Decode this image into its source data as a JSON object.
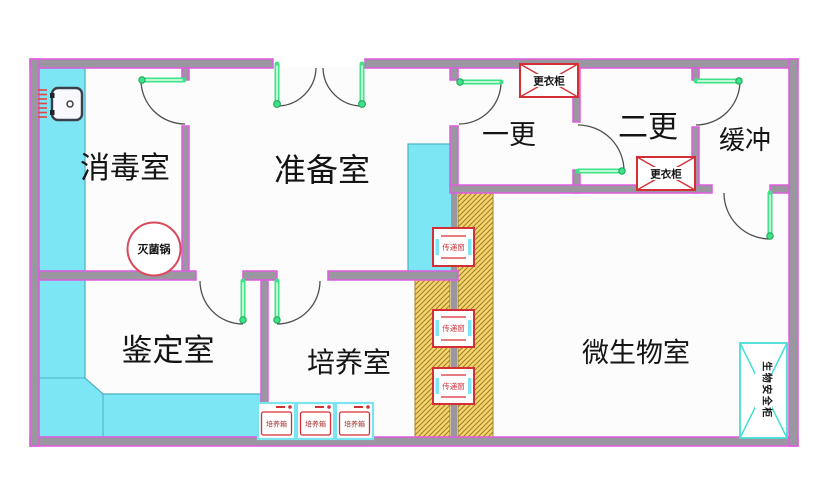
{
  "rooms": [
    {
      "label": "消毒室"
    },
    {
      "label": "准备室"
    },
    {
      "label": "一更"
    },
    {
      "label": "二更"
    },
    {
      "label": "缓冲"
    },
    {
      "label": "鉴定室"
    },
    {
      "label": "培养室"
    },
    {
      "label": "微生物室"
    }
  ],
  "equipment": {
    "sterilizer_label": "灭菌锅",
    "locker_label": "更衣柜",
    "incubator_label": "培养箱",
    "transfer_window_label": "传递窗",
    "biosafety_cabinet_label": "生物安全柜"
  },
  "colors": {
    "wall-core": "#9b97a0",
    "wall-edge": "#df5bdf",
    "floor": "#fdfcfd",
    "bench": "#7de6f4",
    "bench-edge": "#4ab0c4",
    "hatch-bg": "#f5d56d",
    "hatch-line": "#a2802a",
    "door-green": "#3ee287",
    "door-green-dark": "#16a553",
    "arc": "#4f4f4f",
    "red": "#d42f35",
    "incubator-text": "#a63030",
    "teal": "#47ded4",
    "text": "#141414"
  }
}
